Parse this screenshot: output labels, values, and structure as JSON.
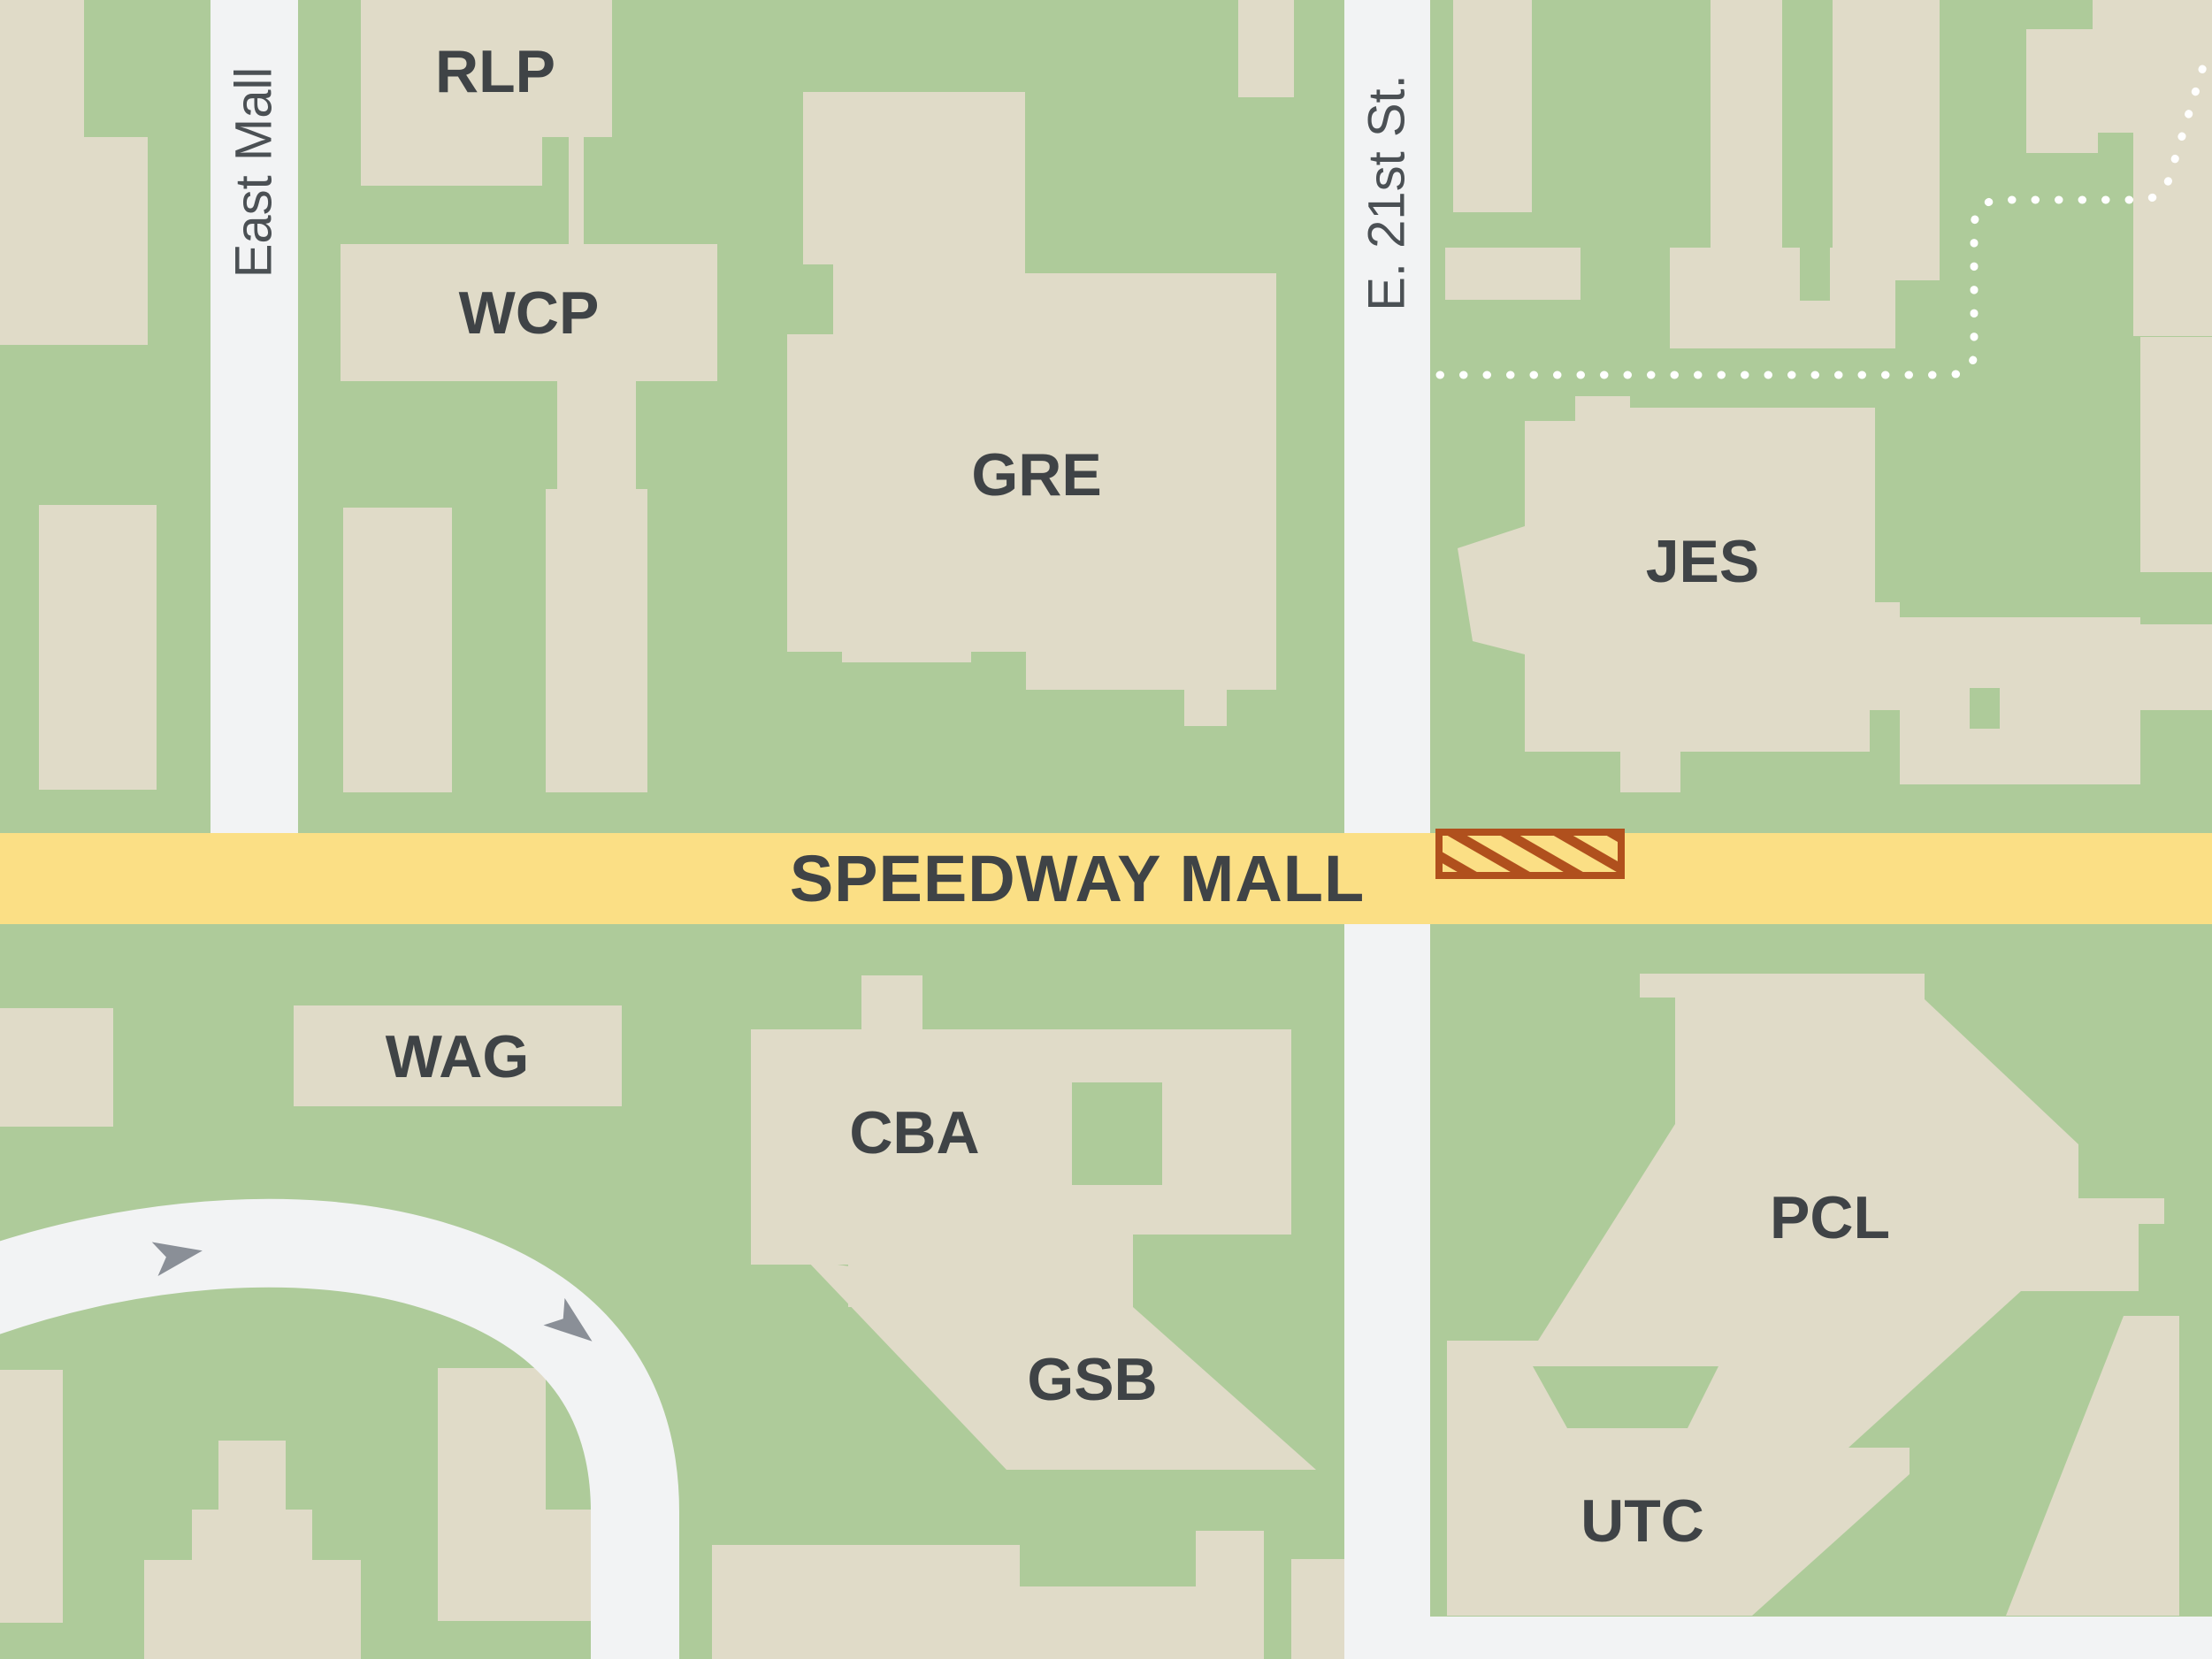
{
  "map": {
    "title": "campus map",
    "streets": {
      "east_mall": "East Mall",
      "e21st": "E. 21st St.",
      "speedway": "SPEEDWAY MALL"
    },
    "buildings": {
      "rlp": "RLP",
      "wcp": "WCP",
      "gre": "GRE",
      "jes": "JES",
      "wag": "WAG",
      "cba": "CBA",
      "gsb": "GSB",
      "pcl": "PCL",
      "utc": "UTC"
    },
    "markers": {
      "construction_zone": "hatched-rectangle-on-speedway-mall-east-of-e21st"
    },
    "colors": {
      "ground_green": "#AECB9A",
      "building_beige": "#E0DBC8",
      "road_white": "#F2F3F4",
      "speedway_yellow": "#FBDF85",
      "construction_orange": "#B0501D",
      "label_dark": "#3F4346",
      "street_label_gray": "#4B5054",
      "arrow_gray": "#8A8F97",
      "trail_dotted": "#FFFFFF"
    }
  }
}
